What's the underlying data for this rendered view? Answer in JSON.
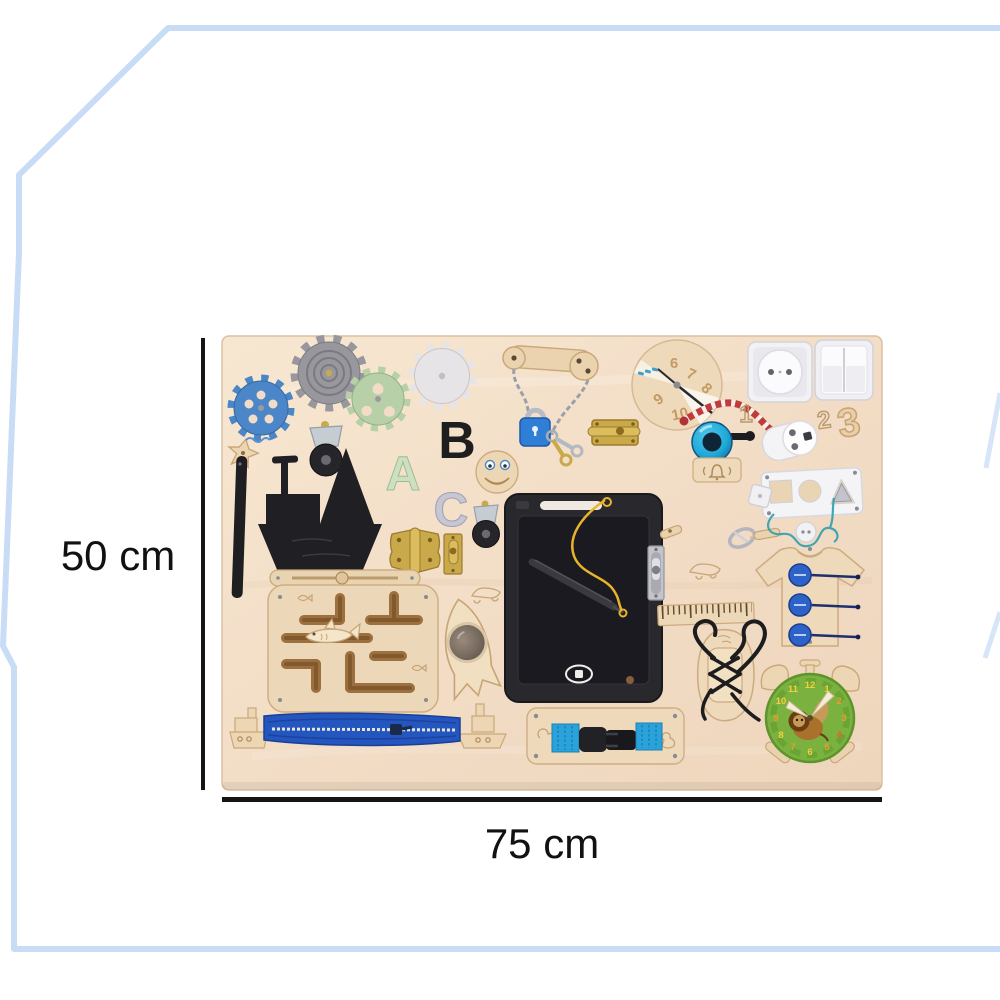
{
  "dimensions": {
    "height_label": "50 cm",
    "width_label": "75 cm"
  },
  "board": {
    "letters": [
      "A",
      "B",
      "C"
    ],
    "engraved_numbers": [
      "1",
      "2"
    ],
    "wooden_number": "3",
    "spinner_numbers": [
      "6",
      "7",
      "8",
      "9",
      "10"
    ],
    "clock_numbers": [
      "12",
      "1",
      "2",
      "3",
      "4",
      "5",
      "6",
      "7",
      "8",
      "9",
      "10",
      "11"
    ],
    "elements": [
      "blue-gear",
      "gray-gear",
      "green-gear",
      "white-gear",
      "wooden-latch-with-chain",
      "blue-padlock-with-keys",
      "brass-slide-bolt",
      "number-spinner-wheel",
      "red-white-rope",
      "power-socket",
      "light-switch",
      "power-plug",
      "ring-bell",
      "bell-engraving-plate",
      "wooden-number-three",
      "wooden-star",
      "black-strap",
      "caster-wheel",
      "letter-A",
      "letter-B",
      "letter-C",
      "smiley-face",
      "chalkboard-ship",
      "brass-hinge",
      "small-brass-bolt",
      "lcd-writing-tablet",
      "stylus-on-cord",
      "silver-door-bolt",
      "wooden-toggle",
      "wooden-ruler",
      "carabiner-with-toggle",
      "shape-sorter-panel",
      "white-button",
      "t-shirt-with-buttons",
      "shark-maze",
      "wooden-slide-latch",
      "rocket-with-mirror",
      "car-engraving",
      "lacing-shoe",
      "alarm-clock-puzzle",
      "zipper-with-boats",
      "buckle-board"
    ],
    "colors": {
      "frame": "#c9dcf6",
      "board_wood": "#f2ddc6",
      "dimension_line": "#151515",
      "gear_blue": "#4a86c8",
      "padlock_blue": "#2f7fd6",
      "zipper_blue": "#2456c0",
      "strap_blue": "#2aa3dc",
      "bell_blue": "#1fa9d8",
      "clock_green": "#7ab13f",
      "brass": "#c9a94a",
      "rope_red": "#c23b3b",
      "button_blue": "#2d63c8"
    }
  }
}
